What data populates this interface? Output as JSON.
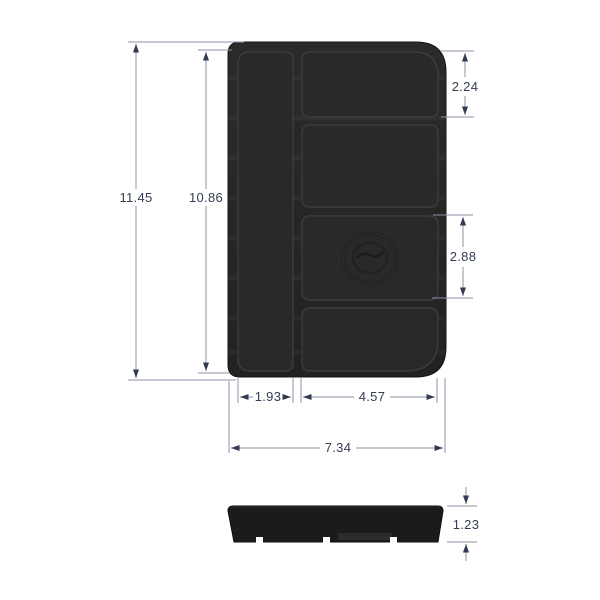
{
  "drawing": {
    "subject": "multi-compartment-tray-technical-drawing",
    "views": {
      "front": "front-view",
      "side": "side-profile-view"
    },
    "logo": "embossed-round-emblem",
    "colors": {
      "background": "#ffffff",
      "tray_body": "#232323",
      "pocket": "#2a2a2a",
      "pocket_edge": "#3c3c3c",
      "extension_line": "#8d93a3",
      "dimension_accent": "#333b52"
    }
  },
  "dims": {
    "overall_height": "11.45",
    "inner_height": "10.86",
    "top_pocket_height": "2.24",
    "logo_pocket_height": "2.88",
    "left_pocket_width": "1.93",
    "right_pocket_width": "4.57",
    "overall_width": "7.34",
    "thickness": "1.23"
  }
}
